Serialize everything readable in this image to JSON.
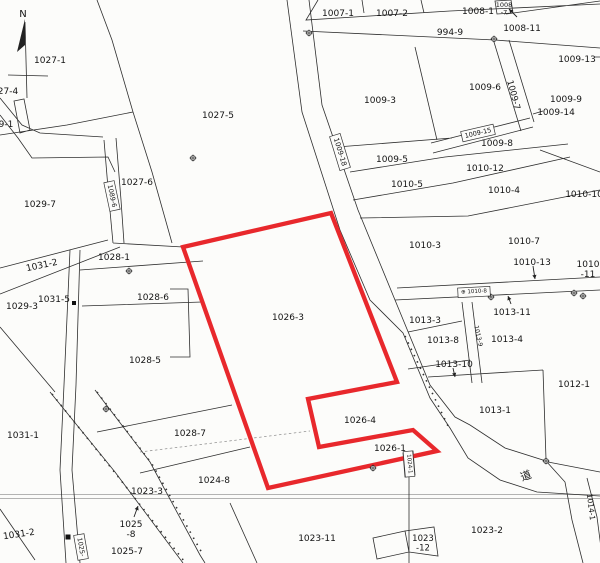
{
  "map": {
    "background": "#fcfcfa",
    "line_color": "#2e2e2e",
    "text_color": "#141414",
    "north_label": "N",
    "highlight": {
      "color": "#e8282c",
      "stroke_width": 4.3,
      "points": [
        [
          183,
          247
        ],
        [
          331,
          213
        ],
        [
          397,
          382
        ],
        [
          308,
          399
        ],
        [
          319,
          447
        ],
        [
          413,
          430
        ],
        [
          437,
          451
        ],
        [
          268,
          488
        ]
      ],
      "parcel_ids": [
        "1026-3",
        "1026-4",
        "1026-1"
      ]
    },
    "labels": [
      {
        "t": "1027-1",
        "x": 50,
        "y": 61
      },
      {
        "t": "27-4",
        "x": 8,
        "y": 92
      },
      {
        "t": "9-1",
        "x": 6,
        "y": 125
      },
      {
        "t": "1029-7",
        "x": 40,
        "y": 205
      },
      {
        "t": "1027-5",
        "x": 218,
        "y": 116
      },
      {
        "t": "1027-6",
        "x": 137,
        "y": 183
      },
      {
        "t": "1031-2",
        "x": 42,
        "y": 266,
        "r": -12
      },
      {
        "t": "1028-1",
        "x": 114,
        "y": 258
      },
      {
        "t": "1031-5",
        "x": 54,
        "y": 300
      },
      {
        "t": "1029-3",
        "x": 22,
        "y": 307
      },
      {
        "t": "1028-6",
        "x": 153,
        "y": 298
      },
      {
        "t": "1028-5",
        "x": 145,
        "y": 361
      },
      {
        "t": "1026-3",
        "x": 288,
        "y": 318
      },
      {
        "t": "1026-4",
        "x": 360,
        "y": 421
      },
      {
        "t": "1026-1",
        "x": 390,
        "y": 449
      },
      {
        "t": "1028-7",
        "x": 190,
        "y": 434
      },
      {
        "t": "1031-1",
        "x": 23,
        "y": 436
      },
      {
        "t": "1024-8",
        "x": 214,
        "y": 481
      },
      {
        "t": "1023-3",
        "x": 147,
        "y": 492
      },
      {
        "t": "1031-2",
        "x": 19,
        "y": 535,
        "r": -8
      },
      {
        "t": "1025-7",
        "x": 127,
        "y": 552
      },
      {
        "t": "1023-11",
        "x": 317,
        "y": 539
      },
      {
        "t": "1023-2",
        "x": 487,
        "y": 531
      },
      {
        "t": "1007-1",
        "x": 338,
        "y": 14
      },
      {
        "t": "1007-2",
        "x": 392,
        "y": 14
      },
      {
        "t": "1008-1",
        "x": 478,
        "y": 12
      },
      {
        "t": "994-9",
        "x": 450,
        "y": 33
      },
      {
        "t": "1008-11",
        "x": 522,
        "y": 29
      },
      {
        "t": "1009-3",
        "x": 380,
        "y": 101
      },
      {
        "t": "1009-6",
        "x": 485,
        "y": 88
      },
      {
        "t": "1009-13",
        "x": 577,
        "y": 60
      },
      {
        "t": "1009-9",
        "x": 566,
        "y": 100
      },
      {
        "t": "1009-14",
        "x": 556,
        "y": 113
      },
      {
        "t": "1009-5",
        "x": 392,
        "y": 160
      },
      {
        "t": "1010-5",
        "x": 407,
        "y": 185
      },
      {
        "t": "1009-8",
        "x": 497,
        "y": 144
      },
      {
        "t": "1010-12",
        "x": 485,
        "y": 169
      },
      {
        "t": "1010-4",
        "x": 504,
        "y": 191
      },
      {
        "t": "1010-10",
        "x": 584,
        "y": 195
      },
      {
        "t": "1010-3",
        "x": 425,
        "y": 246
      },
      {
        "t": "1010-7",
        "x": 524,
        "y": 242
      },
      {
        "t": "1010-13",
        "x": 532,
        "y": 263
      },
      {
        "t": "1013-3",
        "x": 425,
        "y": 321
      },
      {
        "t": "1013-11",
        "x": 512,
        "y": 313
      },
      {
        "t": "1013-8",
        "x": 443,
        "y": 341
      },
      {
        "t": "1013-4",
        "x": 507,
        "y": 340
      },
      {
        "t": "1013-10",
        "x": 454,
        "y": 365
      },
      {
        "t": "1012-1",
        "x": 574,
        "y": 385
      },
      {
        "t": "1013-1",
        "x": 495,
        "y": 411
      },
      {
        "t": "道",
        "x": 526,
        "y": 476,
        "r": -20,
        "s": 11
      },
      {
        "t": "1009-18",
        "x": 340,
        "y": 152,
        "r": 73,
        "s": 7,
        "box": true
      },
      {
        "t": "1089-6",
        "x": 112,
        "y": 196,
        "r": 78,
        "s": 6.5,
        "box": true
      },
      {
        "t": "1009-7",
        "x": 513,
        "y": 95,
        "r": 75,
        "s": 8.5
      },
      {
        "t": "1009-15",
        "x": 478,
        "y": 133,
        "r": -13,
        "s": 6.5,
        "box": true
      },
      {
        "t": "⊕ 1010-8",
        "x": 474,
        "y": 292,
        "r": -3,
        "s": 5.5,
        "box": true
      },
      {
        "t": "1013-9",
        "x": 478,
        "y": 336,
        "r": 78,
        "s": 6
      },
      {
        "t": "1014-1",
        "x": 591,
        "y": 507,
        "r": 83,
        "s": 7.5
      },
      {
        "t": "1024-1",
        "x": 409,
        "y": 464,
        "r": 85,
        "s": 5.5,
        "box": true
      },
      {
        "t": "1025-",
        "x": 81,
        "y": 547,
        "r": 80,
        "s": 6.5,
        "box": true
      }
    ],
    "multiline_labels": [
      {
        "lines": [
          "1008",
          "-7"
        ],
        "x": 504,
        "y": 5,
        "s": 6.5
      },
      {
        "lines": [
          "1010",
          "-11"
        ],
        "x": 588,
        "y": 265,
        "s": 9
      },
      {
        "lines": [
          "1025",
          "-8"
        ],
        "x": 131,
        "y": 525,
        "s": 9
      },
      {
        "lines": [
          "1023",
          "-12"
        ],
        "x": 423,
        "y": 539,
        "s": 8.5
      }
    ],
    "arrows": [
      {
        "x1": 517,
        "y1": 17,
        "x2": 509,
        "y2": 9
      },
      {
        "x1": 533,
        "y1": 266,
        "x2": 535,
        "y2": 279
      },
      {
        "x1": 511,
        "y1": 304,
        "x2": 508,
        "y2": 296
      },
      {
        "x1": 453,
        "y1": 368,
        "x2": 455,
        "y2": 377
      },
      {
        "x1": 134,
        "y1": 517,
        "x2": 138,
        "y2": 506
      }
    ],
    "survey_points": [
      [
        309,
        33
      ],
      [
        494,
        39
      ],
      [
        193,
        158
      ],
      [
        129,
        271
      ],
      [
        463,
        292
      ],
      [
        491,
        297
      ],
      [
        574,
        293
      ],
      [
        583,
        296
      ],
      [
        106,
        409
      ],
      [
        373,
        468
      ],
      [
        546,
        461
      ]
    ],
    "squares": [
      [
        74,
        303,
        4
      ],
      [
        68,
        537,
        5
      ]
    ]
  }
}
